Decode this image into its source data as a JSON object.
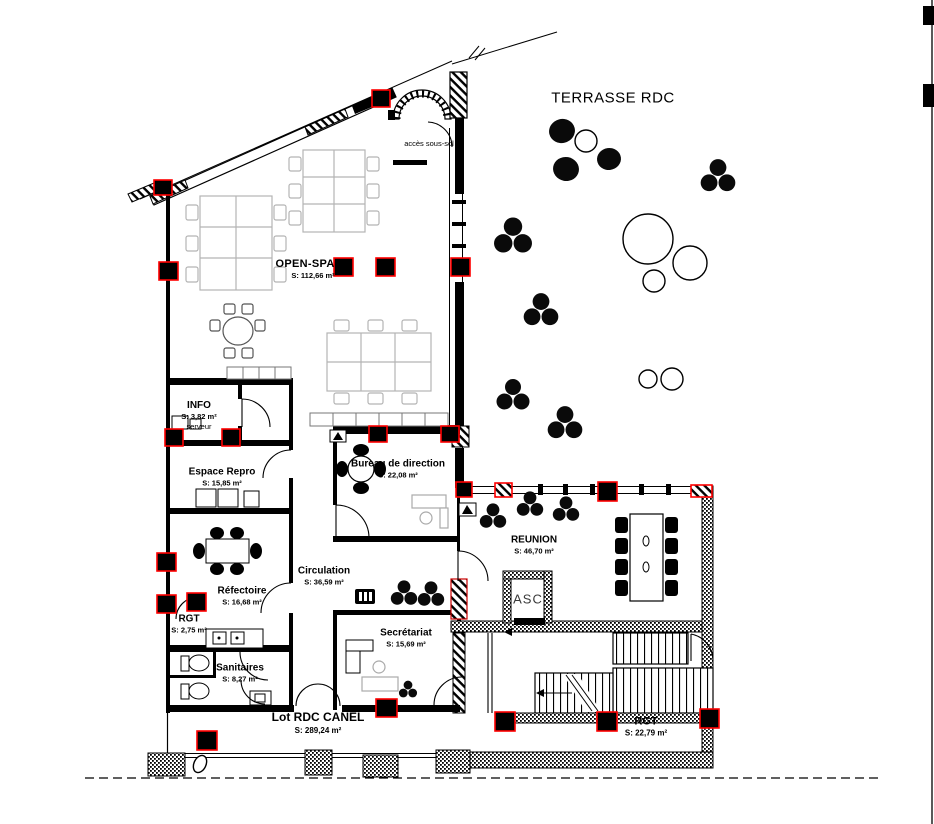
{
  "plan": {
    "terrace_label": "TERRASSE RDC",
    "basement_access_label": "accès sous-sol",
    "elevator_label": "ASC"
  },
  "rooms": [
    {
      "id": "open-space",
      "name": "OPEN-SPACE",
      "area": "S: 112,66 m²"
    },
    {
      "id": "info",
      "name": "INFO",
      "area": "S: 3,82 m²",
      "note": "serveur"
    },
    {
      "id": "espace-repro",
      "name": "Espace Repro",
      "area": "S: 15,85 m²"
    },
    {
      "id": "bureau-direction",
      "name": "Bureau de direction",
      "area": "S: 22,08 m²"
    },
    {
      "id": "reunion",
      "name": "REUNION",
      "area": "S: 46,70 m²"
    },
    {
      "id": "circulation",
      "name": "Circulation",
      "area": "S: 36,59 m²"
    },
    {
      "id": "refectoire",
      "name": "Réfectoire",
      "area": "S: 16,68 m²"
    },
    {
      "id": "rgt-small",
      "name": "RGT",
      "area": "S: 2,75 m²"
    },
    {
      "id": "asc",
      "name": "ASC"
    },
    {
      "id": "secretariat",
      "name": "Secrétariat",
      "area": "S: 15,69 m²"
    },
    {
      "id": "sanitaires",
      "name": "Sanitaires",
      "area": "S: 8,27 m²"
    },
    {
      "id": "lot-rdc-canel",
      "name": "Lot RDC CANEL",
      "area": "S: 289,24 m²"
    },
    {
      "id": "rgt-large",
      "name": "RGT",
      "area": "S: 22,79 m²"
    }
  ],
  "colors": {
    "wall": "#000000",
    "column_accent": "#ff0000",
    "furniture_gray": "#b4b4b4",
    "background": "#ffffff"
  }
}
